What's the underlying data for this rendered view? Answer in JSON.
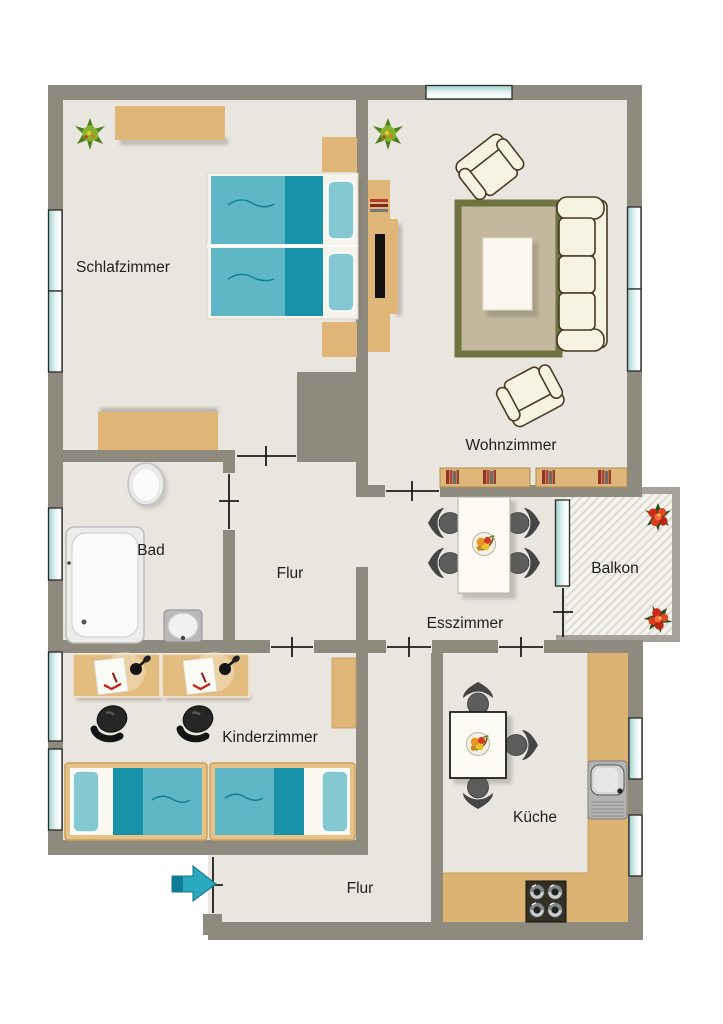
{
  "plan": {
    "type": "apartment-floorplan",
    "rooms": [
      {
        "id": "schlafzimmer",
        "label": "Schlafzimmer"
      },
      {
        "id": "wohnzimmer",
        "label": "Wohnzimmer"
      },
      {
        "id": "bad",
        "label": "Bad"
      },
      {
        "id": "flur-mitte",
        "label": "Flur"
      },
      {
        "id": "esszimmer",
        "label": "Esszimmer"
      },
      {
        "id": "balkon",
        "label": "Balkon"
      },
      {
        "id": "kinderzimmer",
        "label": "Kinderzimmer"
      },
      {
        "id": "kueche",
        "label": "Küche"
      },
      {
        "id": "flur-unten",
        "label": "Flur"
      }
    ],
    "furniture": {
      "schlafzimmer": [
        "wardrobe",
        "double-bed",
        "nightstands",
        "dresser",
        "plant"
      ],
      "wohnzimmer": [
        "tv-board",
        "tv",
        "armchairs",
        "rug",
        "coffee-table",
        "sofa",
        "bookshelves",
        "plant"
      ],
      "bad": [
        "toilet",
        "bathtub",
        "washbasin"
      ],
      "esszimmer": [
        "dining-table",
        "four-chairs",
        "fruit-bowl"
      ],
      "balkon": [
        "flower-boxes"
      ],
      "kinderzimmer": [
        "two-desks",
        "desk-lamps",
        "office-chairs",
        "two-single-beds",
        "shelf"
      ],
      "kueche": [
        "kitchen-table",
        "three-chairs",
        "fruit-bowl",
        "counter",
        "sink",
        "stove"
      ],
      "flur-unten": [
        "entrance-arrow"
      ]
    },
    "entrance": {
      "side": "bottom-left",
      "arrow_direction": "right"
    },
    "colors": {
      "wall": "#8f8a7e",
      "balcony_border": "#a6a199",
      "floor": "#e9e6e0",
      "background": "#ffffff",
      "wood": "#dfb678",
      "counter_wood": "#dbb271",
      "bed_teal_dark": "#1792a8",
      "bed_teal": "#5fb7c5",
      "bed_teal_light": "#84c8d2",
      "window_glass": "#9ccfcc",
      "rug_border": "#6e7340",
      "rug": "#c3b89e",
      "upholstery": "#f7f3e3",
      "upholstery_outline": "#4a3b26",
      "chair_gray": "#575757",
      "entrance_arrow": "#2aa8bc",
      "flower_red": "#cf2a18",
      "plant_green": "#4e7d1d",
      "balcony_hatch": "#d9d6cd",
      "door_line": "#1c1c1c",
      "text": "#1e1e1e"
    }
  }
}
